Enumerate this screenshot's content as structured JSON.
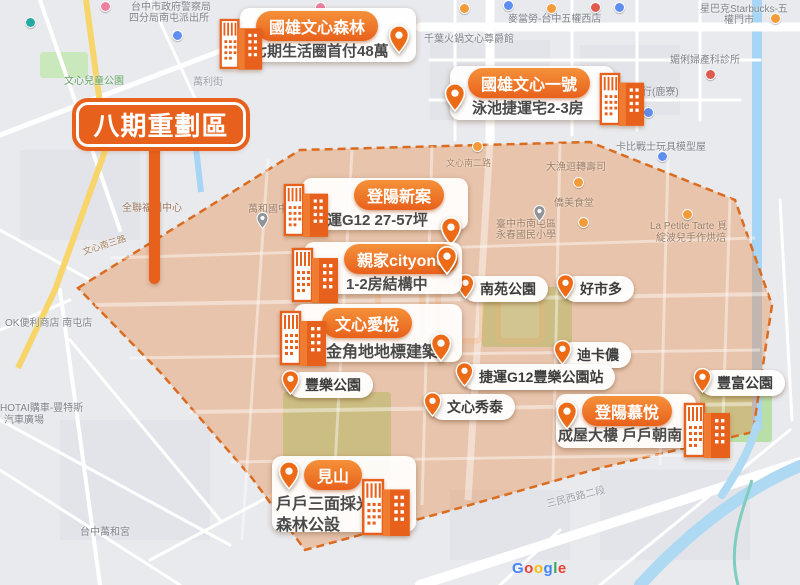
{
  "banner": {
    "label": "八期重劃區"
  },
  "cards": [
    {
      "title": "國雄文心森林",
      "subtitle": "七期生活圈首付48萬"
    },
    {
      "title": "國雄文心一號",
      "subtitle": "泳池捷運宅2-3房"
    },
    {
      "title": "登陽新案",
      "subtitle": "捷運G12 27-57坪"
    },
    {
      "title": "親家cityone",
      "subtitle": "1-2房結構中"
    },
    {
      "title": "文心愛悅",
      "subtitle": "金角地地標建築"
    },
    {
      "title": "登陽慕悅",
      "subtitle": "成屋大樓 戶戶朝南"
    },
    {
      "title": "見山",
      "subtitle": "戶戶三面採光",
      "subtitle2": "森林公設"
    }
  ],
  "poi_pills": [
    {
      "label": "南苑公園"
    },
    {
      "label": "好市多"
    },
    {
      "label": "迪卡儂"
    },
    {
      "label": "捷運G12豐樂公園站"
    },
    {
      "label": "豐樂公園"
    },
    {
      "label": "文心秀泰"
    },
    {
      "label": "豐富公園"
    }
  ],
  "map_labels": [
    {
      "text": "台中市政府警察局"
    },
    {
      "text": "四分局南屯派出所"
    },
    {
      "text": "文心兒童公園"
    },
    {
      "text": "萬利街"
    },
    {
      "text": "麥當勞-台中五權西店"
    },
    {
      "text": "星巴克Starbucks-五"
    },
    {
      "text": "權門市"
    },
    {
      "text": "千葉火鍋文心尊爵館"
    },
    {
      "text": "媚俐婦產科診所"
    },
    {
      "text": "幸福商行(鹿寮)"
    },
    {
      "text": "卡比戰士玩具模型屋"
    },
    {
      "text": "大漁迴轉壽司"
    },
    {
      "text": "文心南二路"
    },
    {
      "text": "僑美食堂"
    },
    {
      "text": "臺中市南屯區"
    },
    {
      "text": "永春國民小學"
    },
    {
      "text": "La Petite Tarte 覓"
    },
    {
      "text": "綻波兒手作烘焙"
    },
    {
      "text": "全聯福利中心"
    },
    {
      "text": "萬和國中"
    },
    {
      "text": "文心南三路"
    },
    {
      "text": "OK便利商店 南屯店"
    },
    {
      "text": "HOTAI購車-豐特斯"
    },
    {
      "text": "汽車廣場"
    },
    {
      "text": "台中萬和宮"
    },
    {
      "text": "三民西路二段"
    }
  ],
  "attribution": {
    "letters": [
      {
        "ch": "G"
      },
      {
        "ch": "o"
      },
      {
        "ch": "o"
      },
      {
        "ch": "g"
      },
      {
        "ch": "l"
      },
      {
        "ch": "e"
      }
    ]
  },
  "colors": {
    "accent_orange": "#e8611c",
    "zone_fill": "#e89050",
    "zone_border": "#d96c1f",
    "water": "#a6d5f5",
    "park_green": "#b9dfa8",
    "google_blue": "#4285F4",
    "google_red": "#EA4335",
    "google_yellow": "#FBBC05",
    "google_green": "#34A853"
  }
}
